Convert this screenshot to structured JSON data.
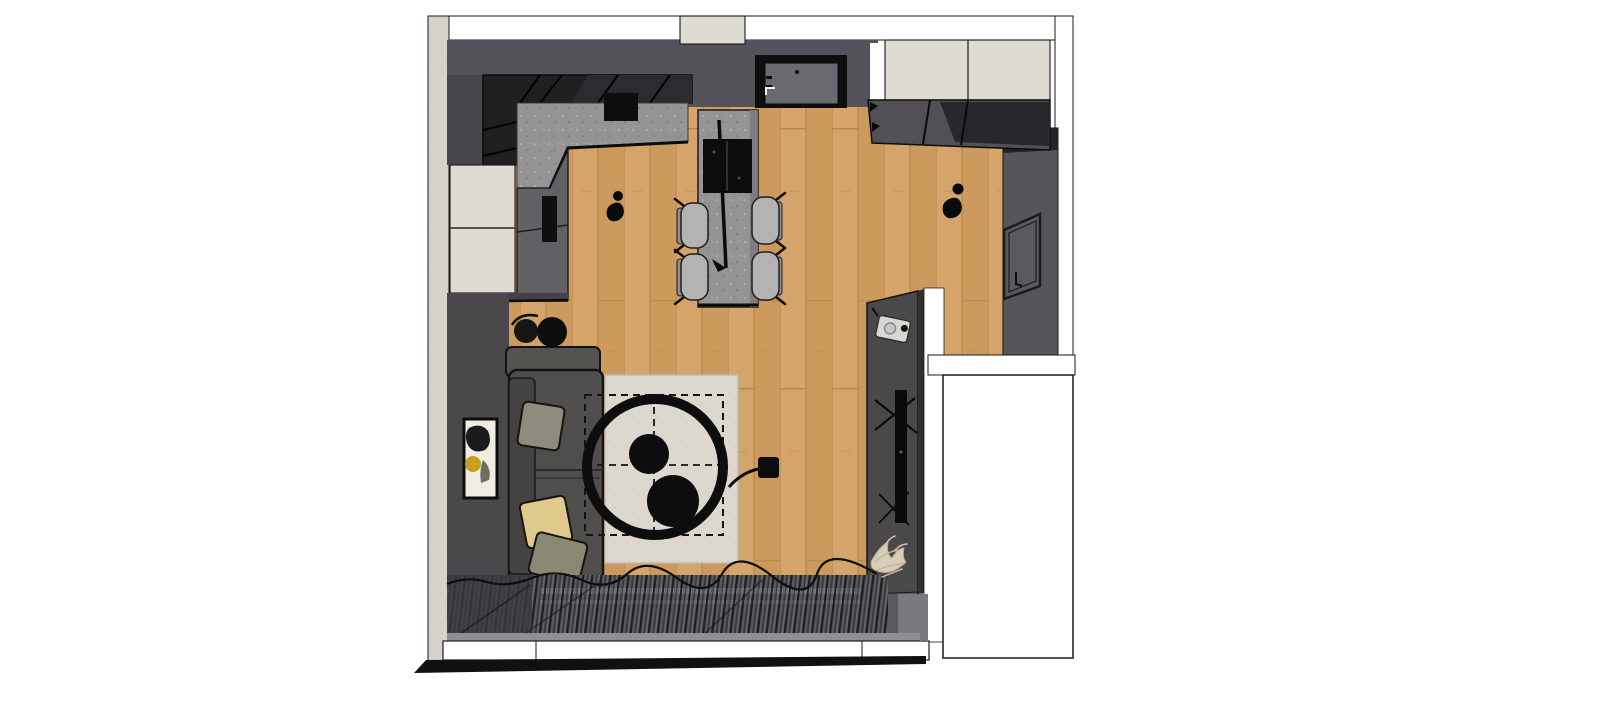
{
  "scene": {
    "kind": "3d-rendered-top-view-floor-plan",
    "room": "living-room-with-open-kitchen",
    "objects": [
      "textured-exterior-wall",
      "wood-floor",
      "kitchen-tall-black-units",
      "kitchen-countertop",
      "counter-cooktop",
      "cream-base-cabinets",
      "cabinet-fronts",
      "entrance-door",
      "hallway-wardrobe",
      "kitchen-island",
      "island-hob",
      "bar-chairs",
      "pendant-lamp",
      "decor-figurine-left",
      "decor-figurine-right",
      "right-wall",
      "leaning-wall-frame",
      "sofa",
      "sofa-cushions",
      "round-side-tables",
      "picture-frame",
      "area-rug",
      "dashed-layout-outline",
      "round-coffee-table",
      "serving-bowls",
      "arc-floor-lamp",
      "media-wall",
      "tv",
      "media-device",
      "dried-plant",
      "curtains",
      "window-sill",
      "balcony-edge",
      "adjacent-room",
      "corridor"
    ]
  },
  "palette": {
    "page_bg": "#ffffff",
    "white_wall": "#ffffff",
    "wood": "#d2a066",
    "wood_dark": "#cd9a5e",
    "wood_line": "#b9854b",
    "wall_dark": "#55535a",
    "wall_left": "#4a484a",
    "wall_right": "#57555a",
    "media_panel": "#4a4849",
    "units_black": "#202023",
    "counter_speckle": "#959394",
    "cream": "#dedbd2",
    "front_gray": "#636166",
    "door_panel": "#6b6970",
    "sofa": "#504e4d",
    "cushion_green": "#8f8c7d",
    "cushion_yellow": "#e0c98c",
    "cushion_olive": "#8a8772",
    "chair": "#b5b3b2",
    "rug": "#dcd8cf",
    "curtain": "#46454a",
    "exterior_texture": "#d6d3cc",
    "art_yellow": "#c99f1e",
    "ink": "#0d0d0d"
  }
}
